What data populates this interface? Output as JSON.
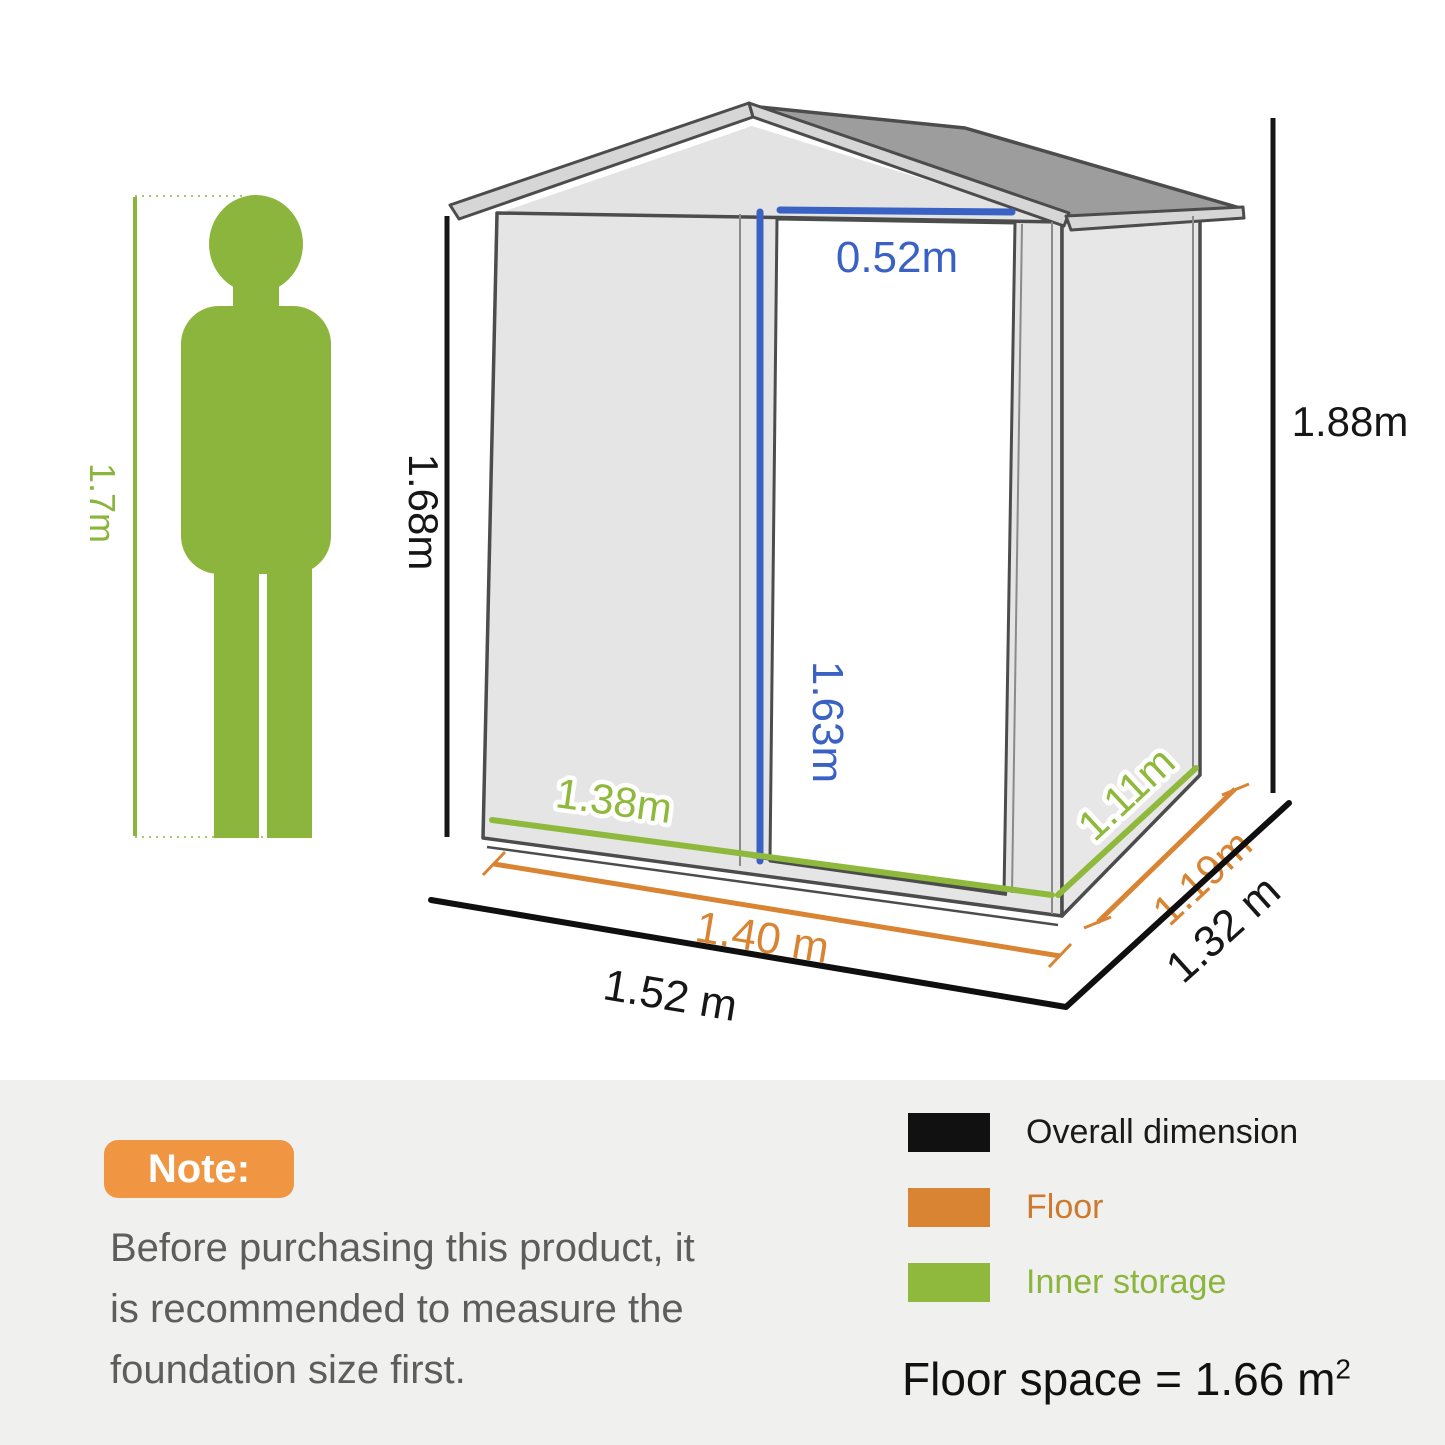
{
  "dimensions": {
    "person_height": "1.7m",
    "overall_height": "1.88m",
    "wall_height": "1.68m",
    "door_height": "1.63m",
    "door_width": "0.52m",
    "inner_width": "1.38m",
    "inner_depth": "1.11m",
    "floor_width": "1.40 m",
    "floor_depth": "1.19m",
    "overall_width": "1.52 m",
    "overall_depth": "1.32 m"
  },
  "colors": {
    "overall_dimension": "#111111",
    "floor": "#d98432",
    "inner_storage": "#8fb93c",
    "door_dimension": "#3a62c4",
    "person": "#8cb53d",
    "note_badge": "#f09643"
  },
  "note": {
    "badge": "Note:",
    "line1": "Before purchasing this product, it",
    "line2": "is recommended to measure the",
    "line3": "foundation size first."
  },
  "legend": {
    "items": [
      {
        "label": "Overall dimension",
        "color": "#111111"
      },
      {
        "label": "Floor",
        "color": "#d98432"
      },
      {
        "label": "Inner storage",
        "color": "#8fb93c"
      }
    ],
    "floor_space_text": "Floor space = 1.66 m",
    "floor_space_sup": "2"
  }
}
